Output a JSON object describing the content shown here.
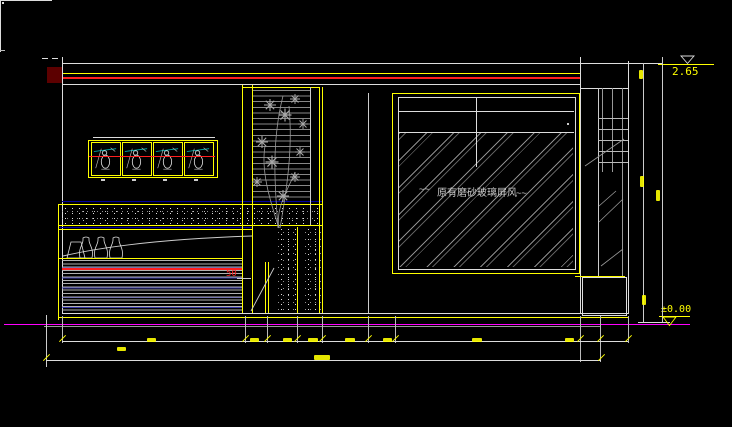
{
  "meta": {
    "drawing_type": "CAD interior elevation, model space"
  },
  "colors": {
    "bg": "#000000",
    "line": "#e6e6e6",
    "gray": "#9a9a9a",
    "yellow": "#ffff00",
    "red": "#ff1f1f",
    "dark_red": "#5c0000",
    "magenta": "#ff00ff",
    "navy": "#0000a0",
    "cyan": "#00b7b7"
  },
  "labels": {
    "level_top": "2.65",
    "level_bottom": "±0.00",
    "gap_width": "50",
    "glass_note": "原有磨砂玻璃屏风",
    "squiggle_left": "~~",
    "squiggle_right": "~~"
  },
  "dimensions": {
    "chain_tick_x": [
      62,
      245,
      267,
      297,
      322,
      368,
      395,
      580,
      600,
      628
    ],
    "overall_tick_x": [
      46,
      601
    ],
    "text_blobs": [
      {
        "x": 147,
        "y": 338,
        "w": 9,
        "h": 4
      },
      {
        "x": 250,
        "y": 338,
        "w": 9,
        "h": 4
      },
      {
        "x": 283,
        "y": 338,
        "w": 9,
        "h": 4
      },
      {
        "x": 308,
        "y": 338,
        "w": 10,
        "h": 4
      },
      {
        "x": 345,
        "y": 338,
        "w": 10,
        "h": 4
      },
      {
        "x": 383,
        "y": 338,
        "w": 9,
        "h": 4
      },
      {
        "x": 472,
        "y": 338,
        "w": 10,
        "h": 4
      },
      {
        "x": 565,
        "y": 338,
        "w": 9,
        "h": 4
      },
      {
        "x": 117,
        "y": 347,
        "w": 9,
        "h": 4
      },
      {
        "x": 314,
        "y": 355,
        "w": 16,
        "h": 5
      },
      {
        "x": 639,
        "y": 70,
        "w": 4,
        "h": 9
      },
      {
        "x": 640,
        "y": 176,
        "w": 4,
        "h": 11
      },
      {
        "x": 656,
        "y": 190,
        "w": 4,
        "h": 11
      },
      {
        "x": 642,
        "y": 295,
        "w": 4,
        "h": 10
      }
    ]
  }
}
